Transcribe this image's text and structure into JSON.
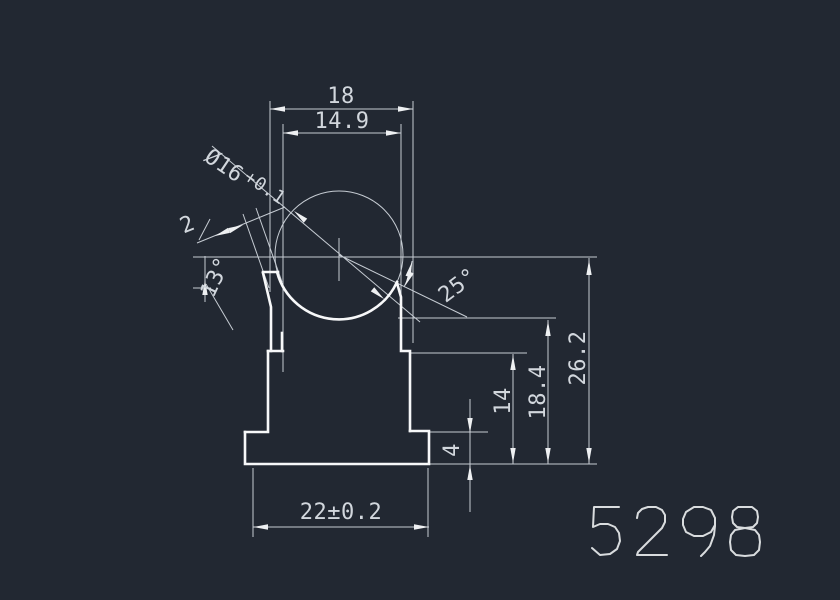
{
  "drawing": {
    "background": "#222832",
    "profile_color": "#f7f8f9",
    "dim_color": "#c6ccd3",
    "text_color": "#d2d7dd",
    "part_number": "5298",
    "dims": {
      "width_top": "18",
      "width_inner": "14.9",
      "bore": "Ø16",
      "bore_tol": "+0.1",
      "lip_thickness": "2",
      "angle_left": "13°",
      "angle_right": "25°",
      "height_total": "26.2",
      "height_mid": "18.4",
      "height_low": "14",
      "base_height": "4",
      "width_base": "22±0.2"
    }
  }
}
